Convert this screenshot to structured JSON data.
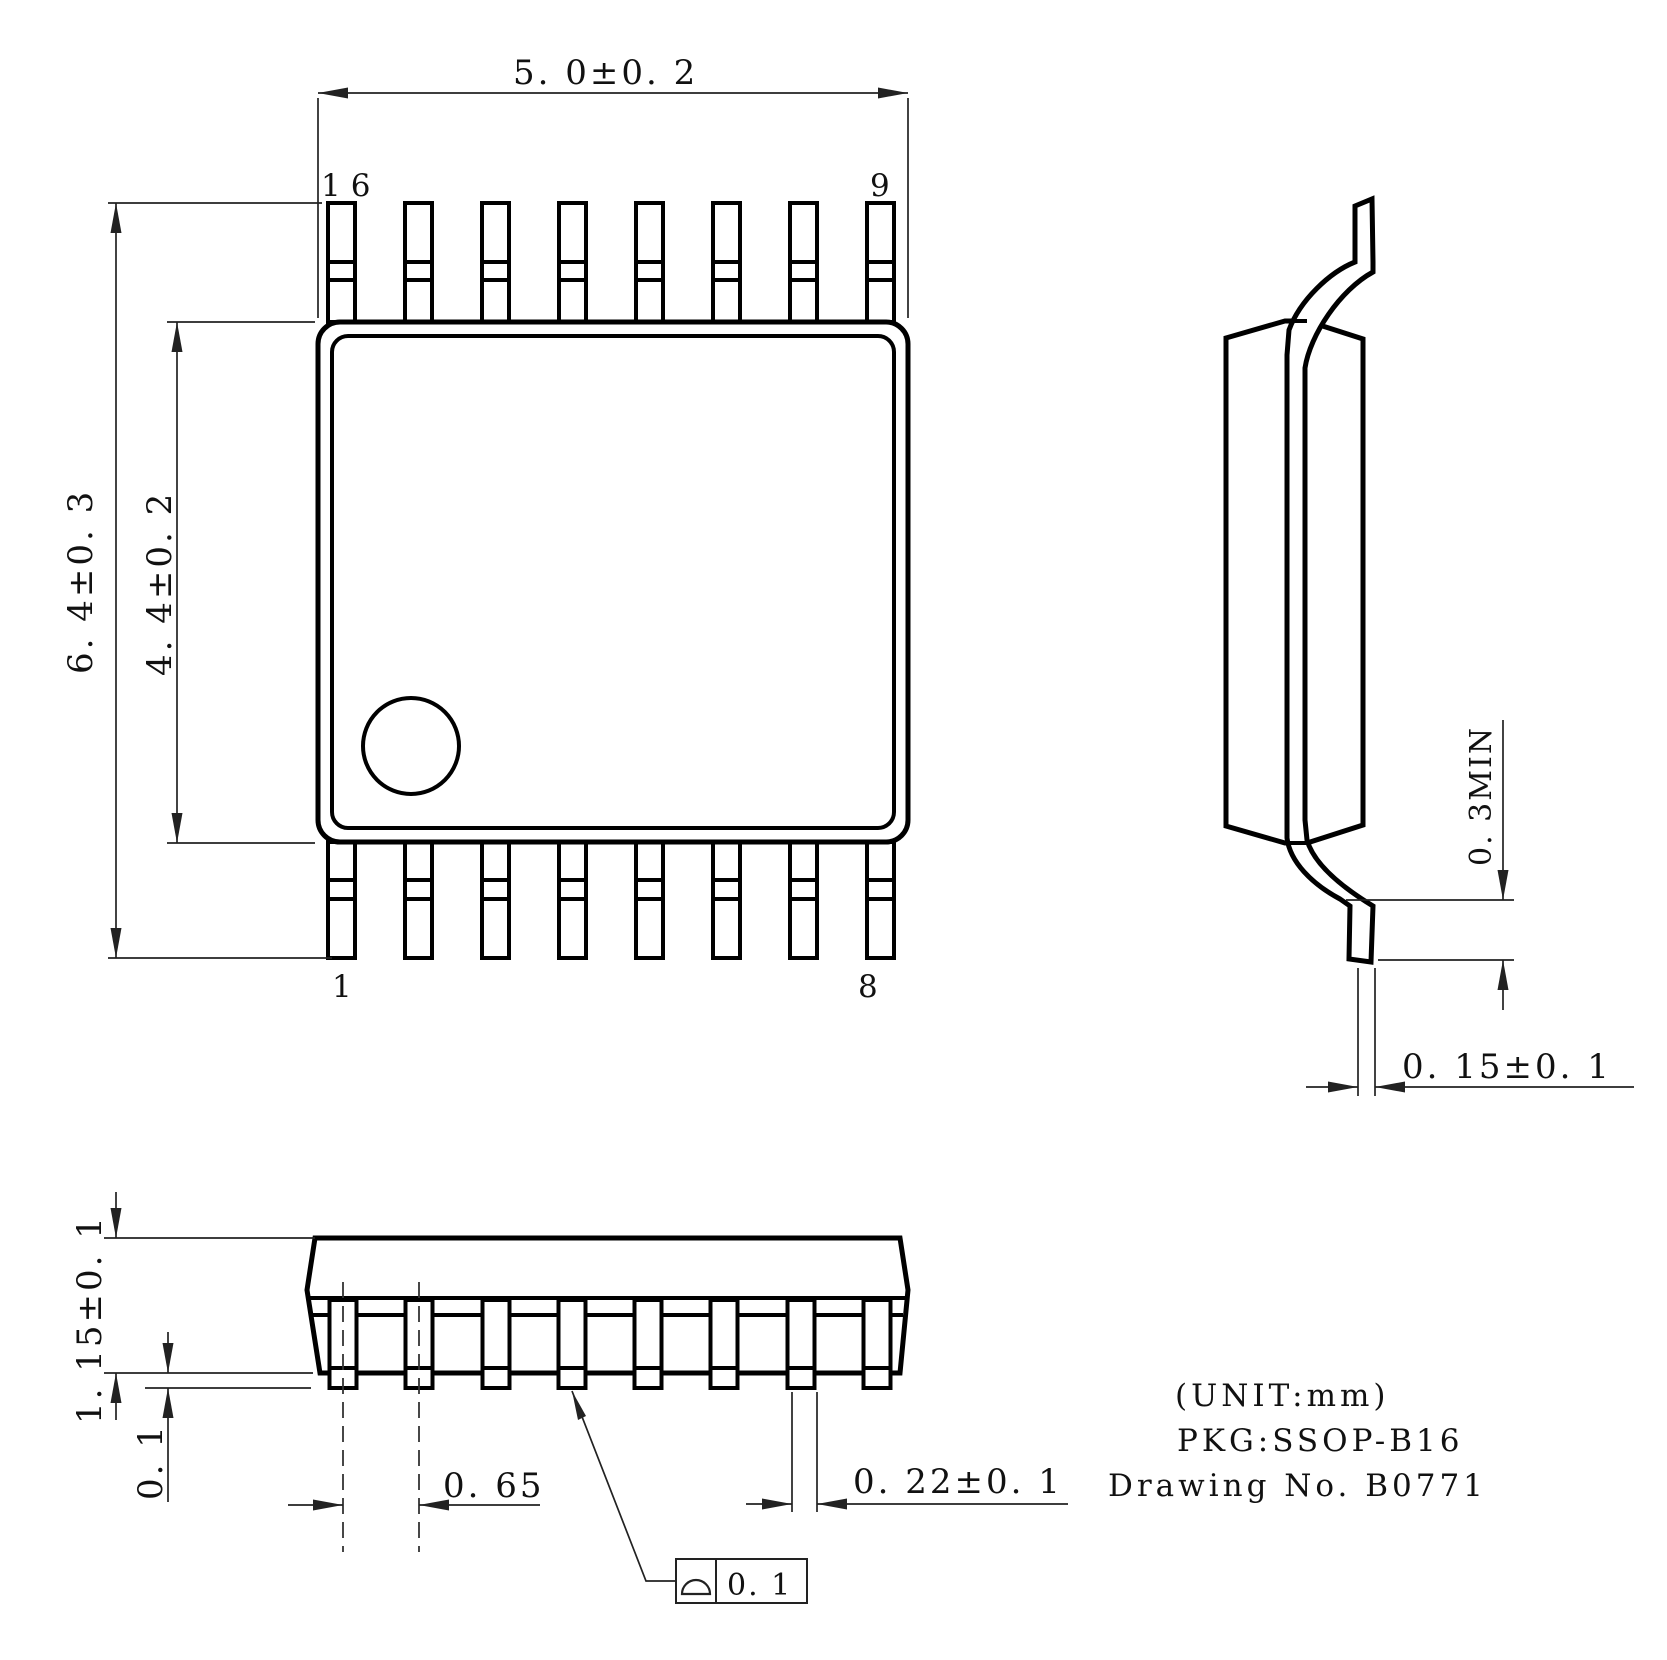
{
  "title_block": {
    "unit_note": "(UNIT:mm)",
    "pkg_label": "PKG:SSOP-B16",
    "drawing_no": "Drawing No. B0771"
  },
  "top_view": {
    "dim_body_width": "5. 0±0. 2",
    "dim_lead_span": "6. 4±0. 3",
    "dim_body_length": "4. 4±0. 2",
    "pin_labels": {
      "top_left": "16",
      "top_right": "9",
      "bottom_left": "1",
      "bottom_right": "8"
    }
  },
  "side_view": {
    "dim_standoff": "0. 3MIN",
    "dim_lead_thickness": "0. 15±0. 1"
  },
  "front_view": {
    "dim_body_height": "1. 15±0. 1",
    "dim_standoff": "0. 1",
    "dim_lead_pitch": "0. 65",
    "dim_lead_width": "0. 22±0. 1",
    "flatness_tolerance": "0. 1"
  }
}
